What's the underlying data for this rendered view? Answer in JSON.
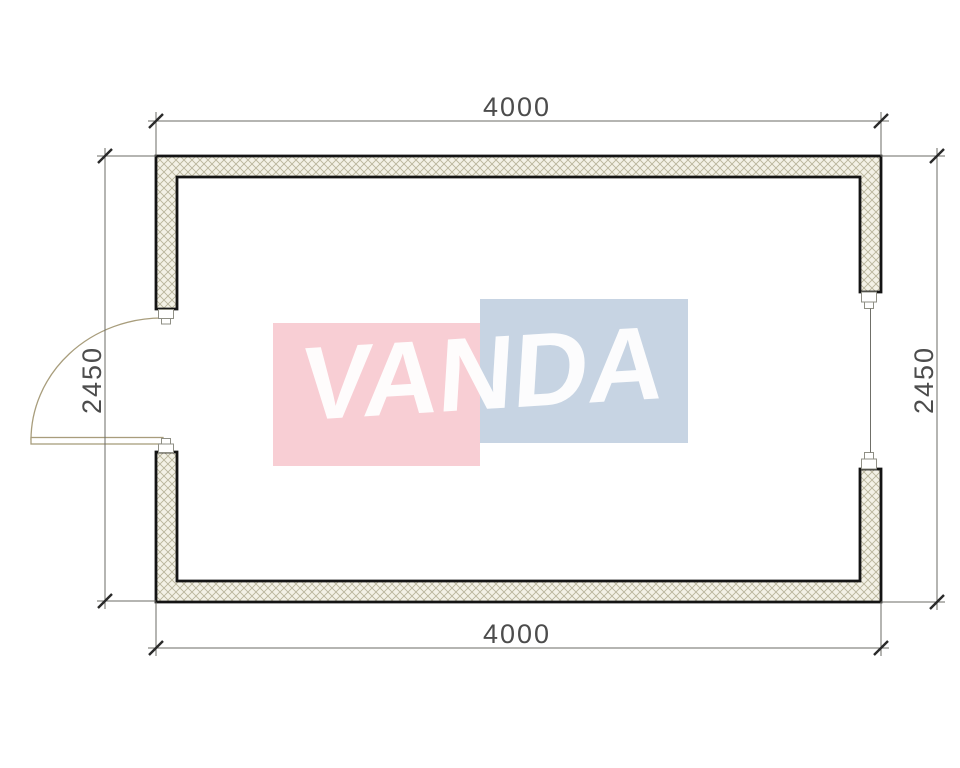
{
  "page": {
    "background": "#ffffff"
  },
  "colors": {
    "wall_outline": "#141414",
    "hatch_bg": "#f3f1e6",
    "hatch_line": "#b8b49b",
    "dim_line": "#6b6b66",
    "tick": "#2a2a2a",
    "dim_text": "#4c4c4c",
    "door": "#a89d7c",
    "window_frame": "#8f8f85",
    "glass": "#6f6f68",
    "logo_pink": "#f8ced4",
    "logo_blue": "#c7d4e3",
    "logo_text_color": "#ffffff"
  },
  "plan": {
    "dim_top": "4000",
    "dim_bottom": "4000",
    "dim_left": "2450",
    "dim_right": "2450"
  },
  "logo": {
    "text": "VANDA"
  }
}
